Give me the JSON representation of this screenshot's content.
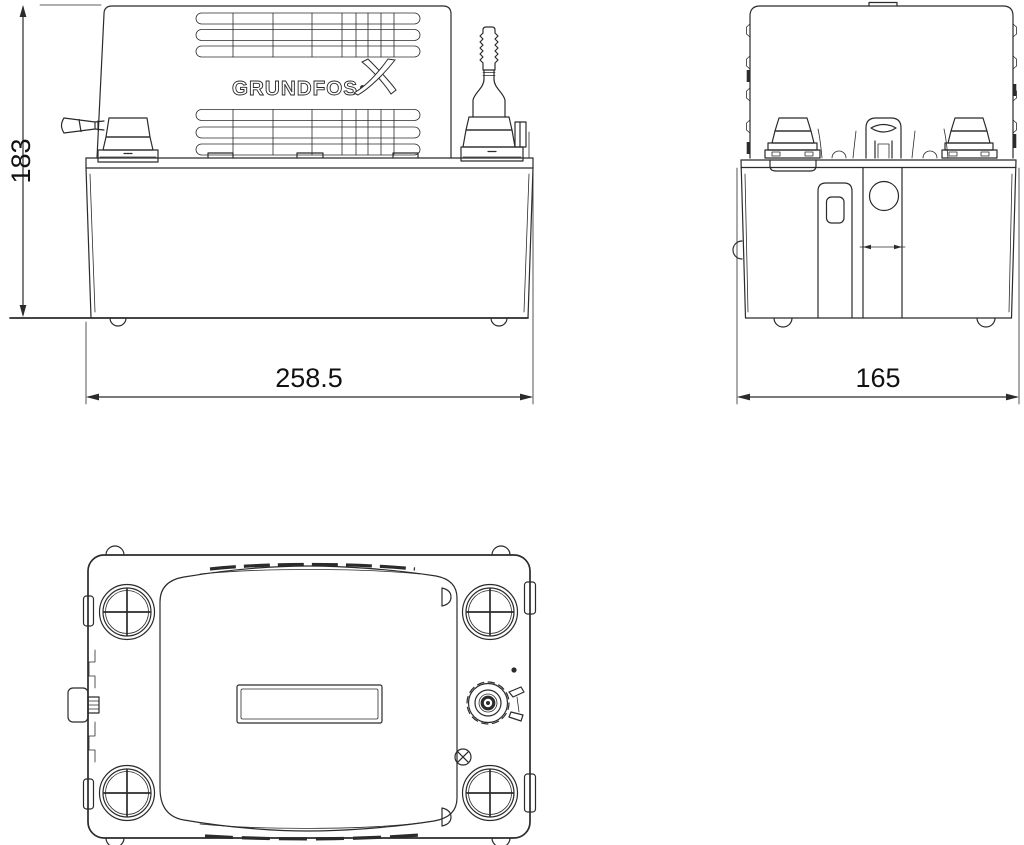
{
  "colors": {
    "line": "#2b2b2b",
    "text": "#111111",
    "background": "#ffffff"
  },
  "logo": {
    "text": "GRUNDFOS"
  },
  "views": {
    "front": {
      "height_label": "183",
      "width_label": "258.5"
    },
    "side": {
      "width_label": "165"
    },
    "bottom": {}
  }
}
